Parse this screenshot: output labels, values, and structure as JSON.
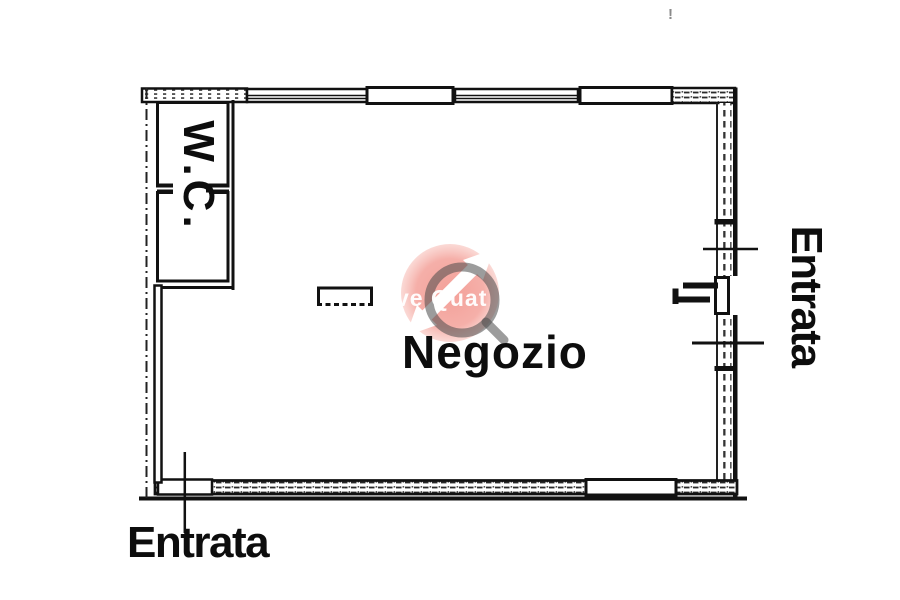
{
  "document": {
    "kind": "scanned floor plan",
    "language": "Italian"
  },
  "labels": {
    "wc": "W.C.",
    "room": "Negozio",
    "entrance_bottom": "Entrata",
    "entrance_right": "Entrata"
  },
  "watermark": {
    "visible_text": "ve Quat",
    "circle_color": "#e84132",
    "ring_color": "#4b4b4b",
    "arrow_color": "#ffffff"
  },
  "colors": {
    "background": "#ffffff",
    "line": "#111111"
  },
  "stray_mark": "!"
}
